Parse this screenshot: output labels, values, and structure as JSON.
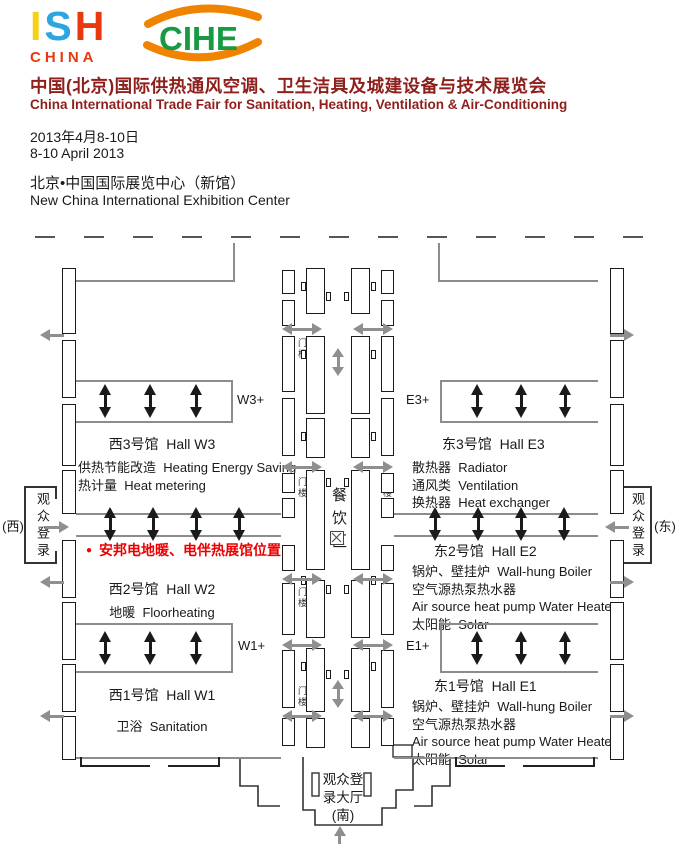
{
  "header": {
    "ish_logo": {
      "letters": [
        {
          "ch": "I",
          "color": "#F5D216"
        },
        {
          "ch": "S",
          "color": "#2CA6E0"
        },
        {
          "ch": "H",
          "color": "#E8380D"
        }
      ],
      "subtitle": "CHINA",
      "subtitle_color": "#E8380D"
    },
    "cihe_logo": {
      "text": "CIHE",
      "text_color": "#189A43",
      "swoosh_color": "#F08300"
    },
    "title_cn": "中国(北京)国际供热通风空调、卫生洁具及城建设备与技术展览会",
    "title_en": "China International Trade Fair for Sanitation, Heating, Ventilation & Air-Conditioning",
    "title_color": "#8E1F1B",
    "date_cn": "2013年4月8-10日",
    "date_en": "8-10 April 2013",
    "venue_cn": "北京•中国国际展览中心（新馆）",
    "venue_en": "New China International Exhibition Center"
  },
  "plan": {
    "halls": {
      "w3": {
        "badge": "W3+",
        "title": "西3号馆  Hall W3",
        "lines": [
          "供热节能改造  Heating Energy Saving",
          "热计量  Heat metering"
        ]
      },
      "e3": {
        "badge": "E3+",
        "title": "东3号馆  Hall E3",
        "lines": [
          "散热器  Radiator",
          "通风类  Ventilation",
          "换热器  Heat exchanger"
        ]
      },
      "w2": {
        "title": "西2号馆  Hall W2",
        "lines": [
          "地暖  Floorheating"
        ]
      },
      "e2": {
        "title": "东2号馆  Hall E2",
        "lines": [
          "锅炉、壁挂炉  Wall-hung Boiler",
          "空气源热泵热水器",
          "Air source heat pump Water Heater",
          "太阳能  Solar"
        ]
      },
      "w1": {
        "badge": "W1+",
        "title": "西1号馆  Hall W1",
        "lines": [
          "卫浴  Sanitation"
        ]
      },
      "e1": {
        "badge": "E1+",
        "title": "东1号馆  Hall E1",
        "lines": [
          "锅炉、壁挂炉  Wall-hung Boiler",
          "空气源热泵热水器",
          "Air source heat pump Water Heater",
          "太阳能  Solar"
        ]
      }
    },
    "dining_area": "餐饮区",
    "gate_tower": "门楼",
    "entry_west": {
      "label": "观众登录",
      "direction": "(西)"
    },
    "entry_east": {
      "label": "观众登录",
      "direction": "(东)"
    },
    "entry_south": {
      "lines": [
        "观众登",
        "录大厅",
        "(南)"
      ]
    },
    "annotation": {
      "bullet": "●",
      "text": "安邦电地暖、电伴热展馆位置",
      "color": "#EE0000"
    }
  }
}
